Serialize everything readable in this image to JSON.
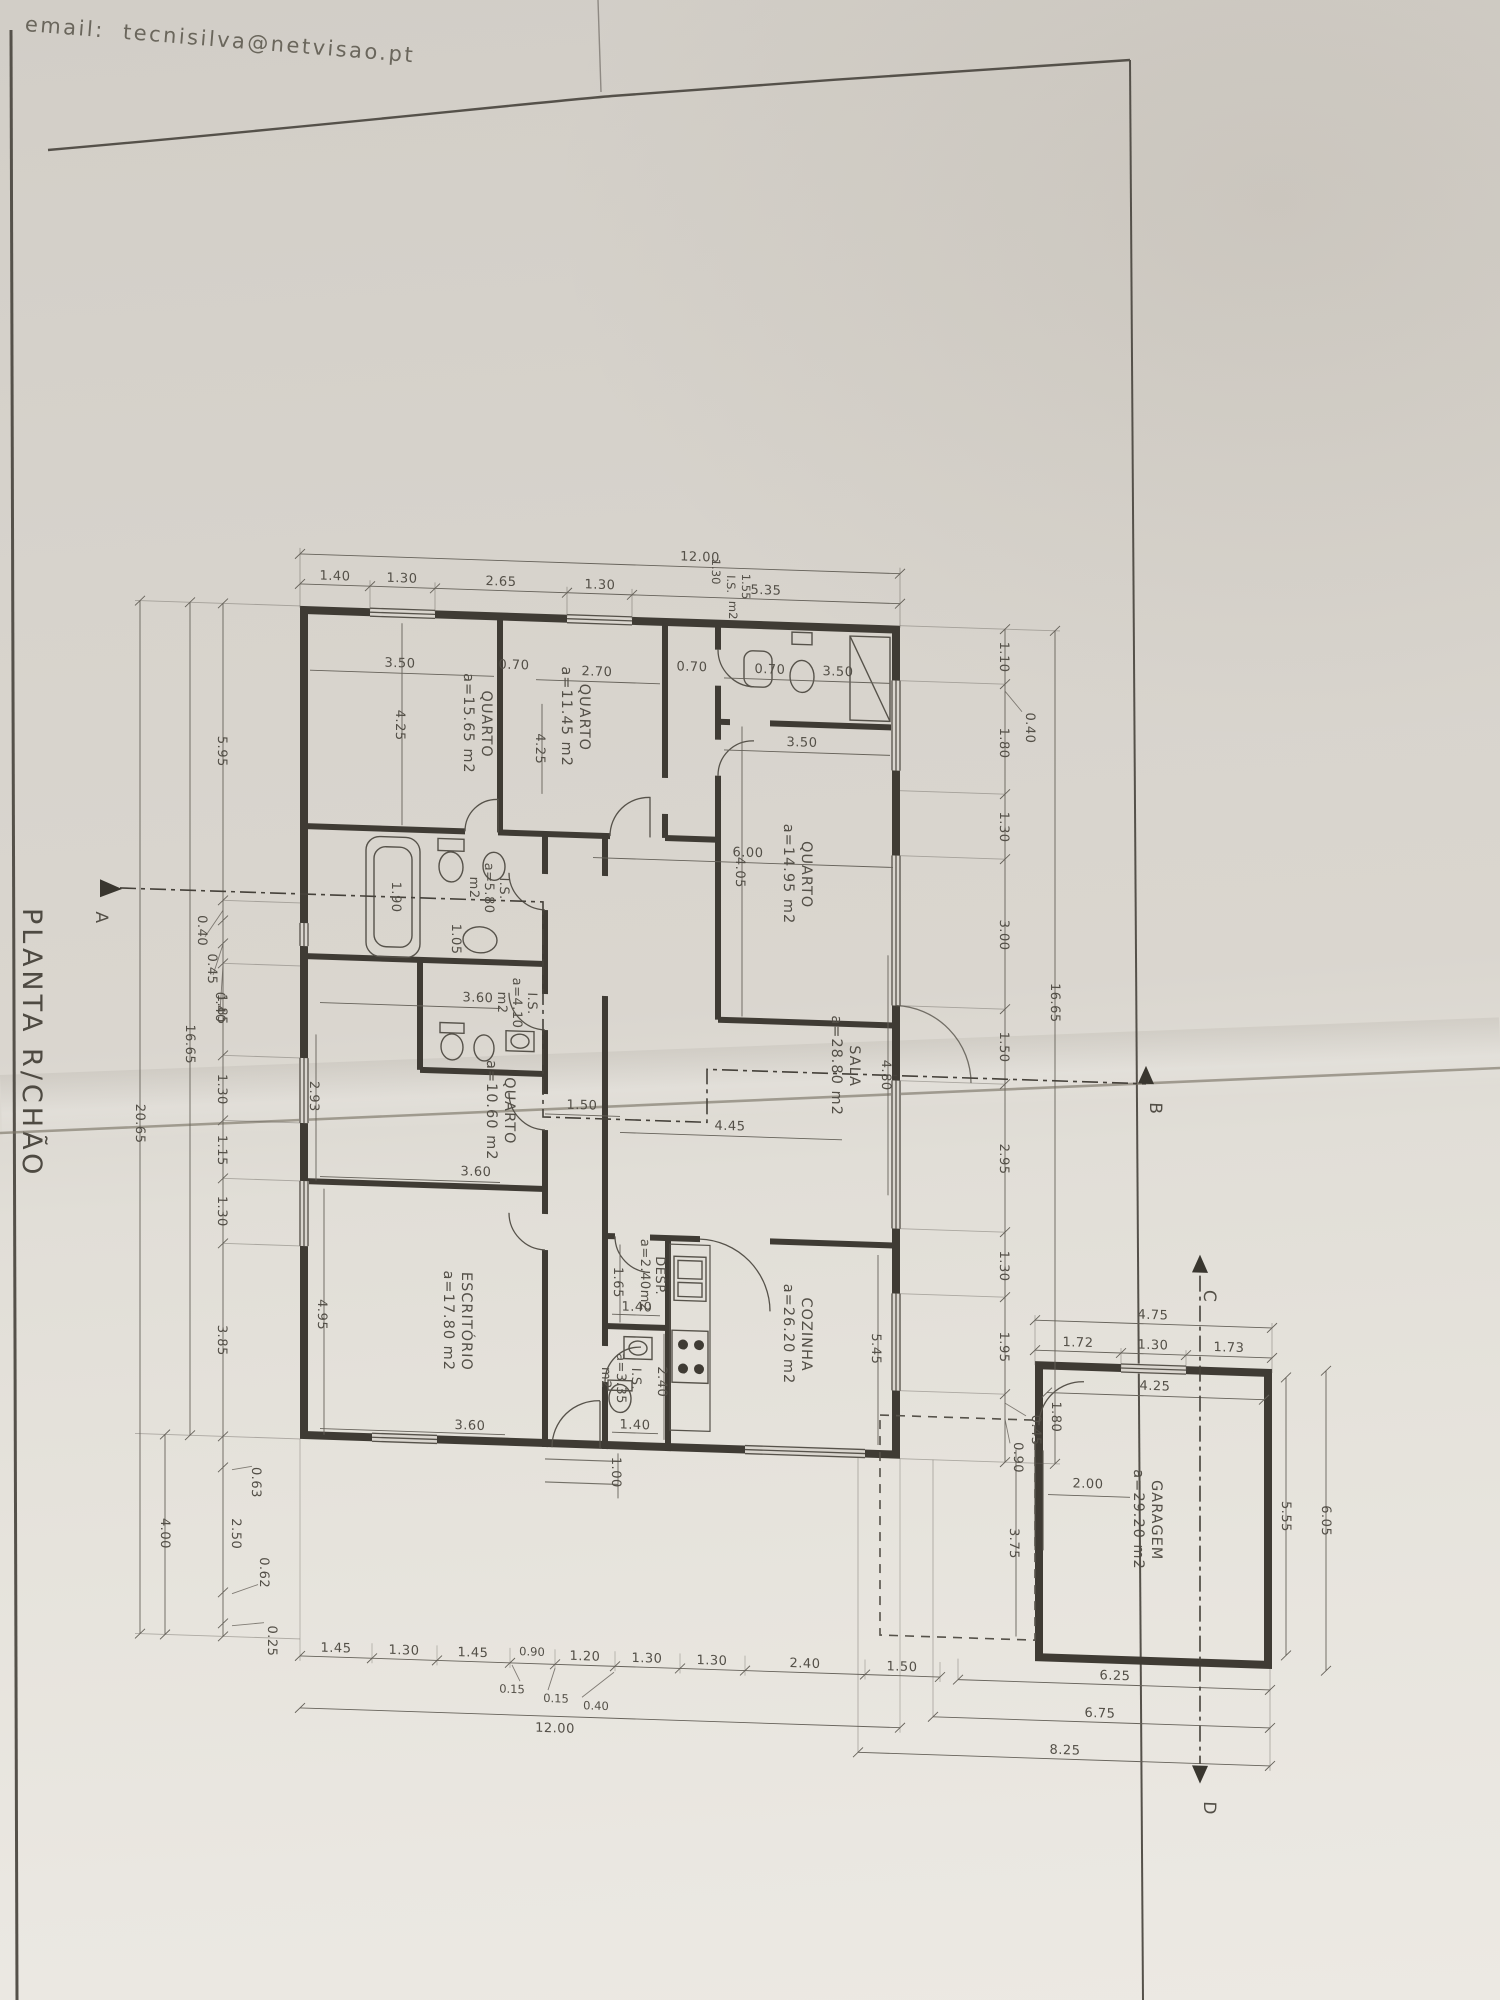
{
  "sheet": {
    "email": "email:  tecnisilva@netvisao.pt",
    "title": "PLANTA R/CHÃO"
  },
  "rooms": {
    "q1": {
      "name": "QUARTO",
      "area": "a=15.65  m2"
    },
    "q2": {
      "name": "QUARTO",
      "area": "a=11.45  m2"
    },
    "q3": {
      "name": "QUARTO",
      "area": "a=14.95  m2"
    },
    "q4": {
      "name": "QUARTO",
      "area": "a=10.60  m2"
    },
    "sala": {
      "name": "SALA",
      "area": "a=28.80  m2"
    },
    "cozinha": {
      "name": "COZINHA",
      "area": "a=26.20  m2"
    },
    "escritorio": {
      "name": "ESCRITÓRIO",
      "area": "a=17.80  m2"
    },
    "desp": {
      "name": "DESP.",
      "area": "a=2.40m2"
    },
    "is580": {
      "name": "I.S.",
      "area": "a=5.80",
      "unit": "m2"
    },
    "is410": {
      "name": "I.S.",
      "area": "a=4.10",
      "unit": "m2"
    },
    "is335": {
      "name": "I.S.",
      "area": "a=3.35",
      "unit": "m2"
    },
    "istop": {
      "name": "I.S.",
      "d1": "1.30",
      "d2": "1.55",
      "unit": "m2"
    },
    "garagem": {
      "name": "GARAGEM",
      "area": "a=29.20  m2"
    }
  },
  "dims": {
    "top": {
      "total": "12.00",
      "segs": [
        "1.40",
        "1.30",
        "2.65",
        "1.30",
        "5.35"
      ]
    },
    "top_inner": {
      "q1w": "3.50",
      "d1": "0.70",
      "q2w": "2.70",
      "d2": "0.70",
      "isw": "3.50",
      "q3w": "3.50",
      "d3": "0.70"
    },
    "left": {
      "segs": [
        "5.95",
        "1.85",
        "1.30",
        "1.15",
        "1.30",
        "3.85"
      ],
      "leaders": [
        "0.40",
        "0.45",
        "0.40"
      ],
      "total1": "16.65",
      "total2": "20.65",
      "annex": "4.00",
      "low1": "0.63",
      "lowseg": "2.50",
      "low2": "0.62",
      "low3": "0.25"
    },
    "right": {
      "segs": [
        "1.10",
        "1.80",
        "1.30",
        "3.00",
        "1.50",
        "2.95",
        "1.30",
        "1.95"
      ],
      "leaders": [
        "0.40",
        "0.45",
        "0.90"
      ],
      "total": "16.65"
    },
    "bottom": {
      "segs": [
        "1.45",
        "1.30",
        "1.45",
        "0.90",
        "1.20",
        "1.30",
        "1.30",
        "2.40",
        "1.50"
      ],
      "leaders": [
        "0.15",
        "0.15",
        "0.40"
      ],
      "total": "12.00"
    },
    "room": {
      "q1h": "4.25",
      "q2h": "4.25",
      "q3h": "4.05",
      "q4h": "2.93",
      "q4w": "3.60",
      "escw1": "3.60",
      "escw2": "3.60",
      "esch": "4.95",
      "salaw": "6.00",
      "salah": "4.80",
      "salaw2": "4.45",
      "corr": "1.50",
      "tub": "1.90",
      "sink": "1.05",
      "desph": "1.65",
      "despw": "1.40",
      "ish": "2.40",
      "isw": "1.40",
      "cozh": "5.45",
      "entry": "1.00"
    },
    "garage": {
      "total": "4.75",
      "segs": [
        "1.72",
        "1.30",
        "1.73"
      ],
      "innerw": "4.25",
      "sidedoor": "1.80",
      "door": "2.00",
      "porch": "3.75",
      "innerh": "5.55",
      "outerh": "6.05",
      "bottoms": [
        "6.25",
        "6.75",
        "8.25"
      ]
    }
  },
  "sections": {
    "a": "A",
    "b": "B",
    "c": "C",
    "d": "D"
  }
}
